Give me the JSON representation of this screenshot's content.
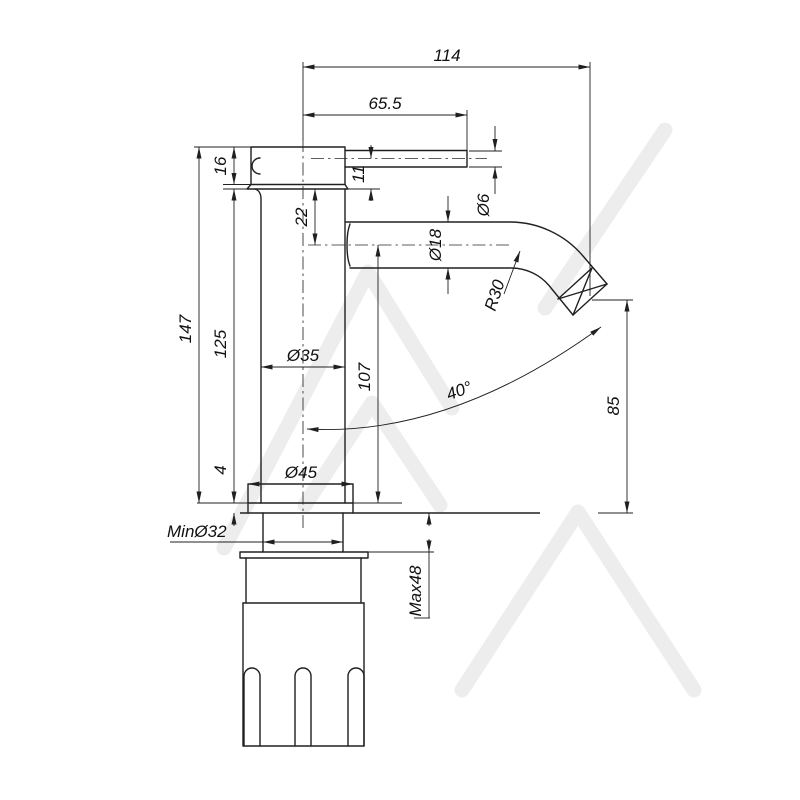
{
  "drawing": {
    "type": "technical-dimension-drawing",
    "subject": "basin pin-lever mixer tap, side elevation",
    "line_color": "#202020",
    "watermark_color": "#ededed",
    "background_color": "#ffffff",
    "labels": {
      "total_width": "114",
      "handle_reach": "65.5",
      "head_height": "16",
      "handle_drop": "11",
      "handle_dia": "Ø6",
      "spout_offset": "22",
      "spout_dia": "Ø18",
      "bend_radius": "R30",
      "total_height": "147",
      "body_height": "125",
      "body_dia": "Ø35",
      "spout_height": "107",
      "spray_angle": "40°",
      "outlet_height": "85",
      "base_height": "4",
      "base_dia": "Ø45",
      "min_hole": "MinØ32",
      "max_counter": "Max48"
    }
  }
}
